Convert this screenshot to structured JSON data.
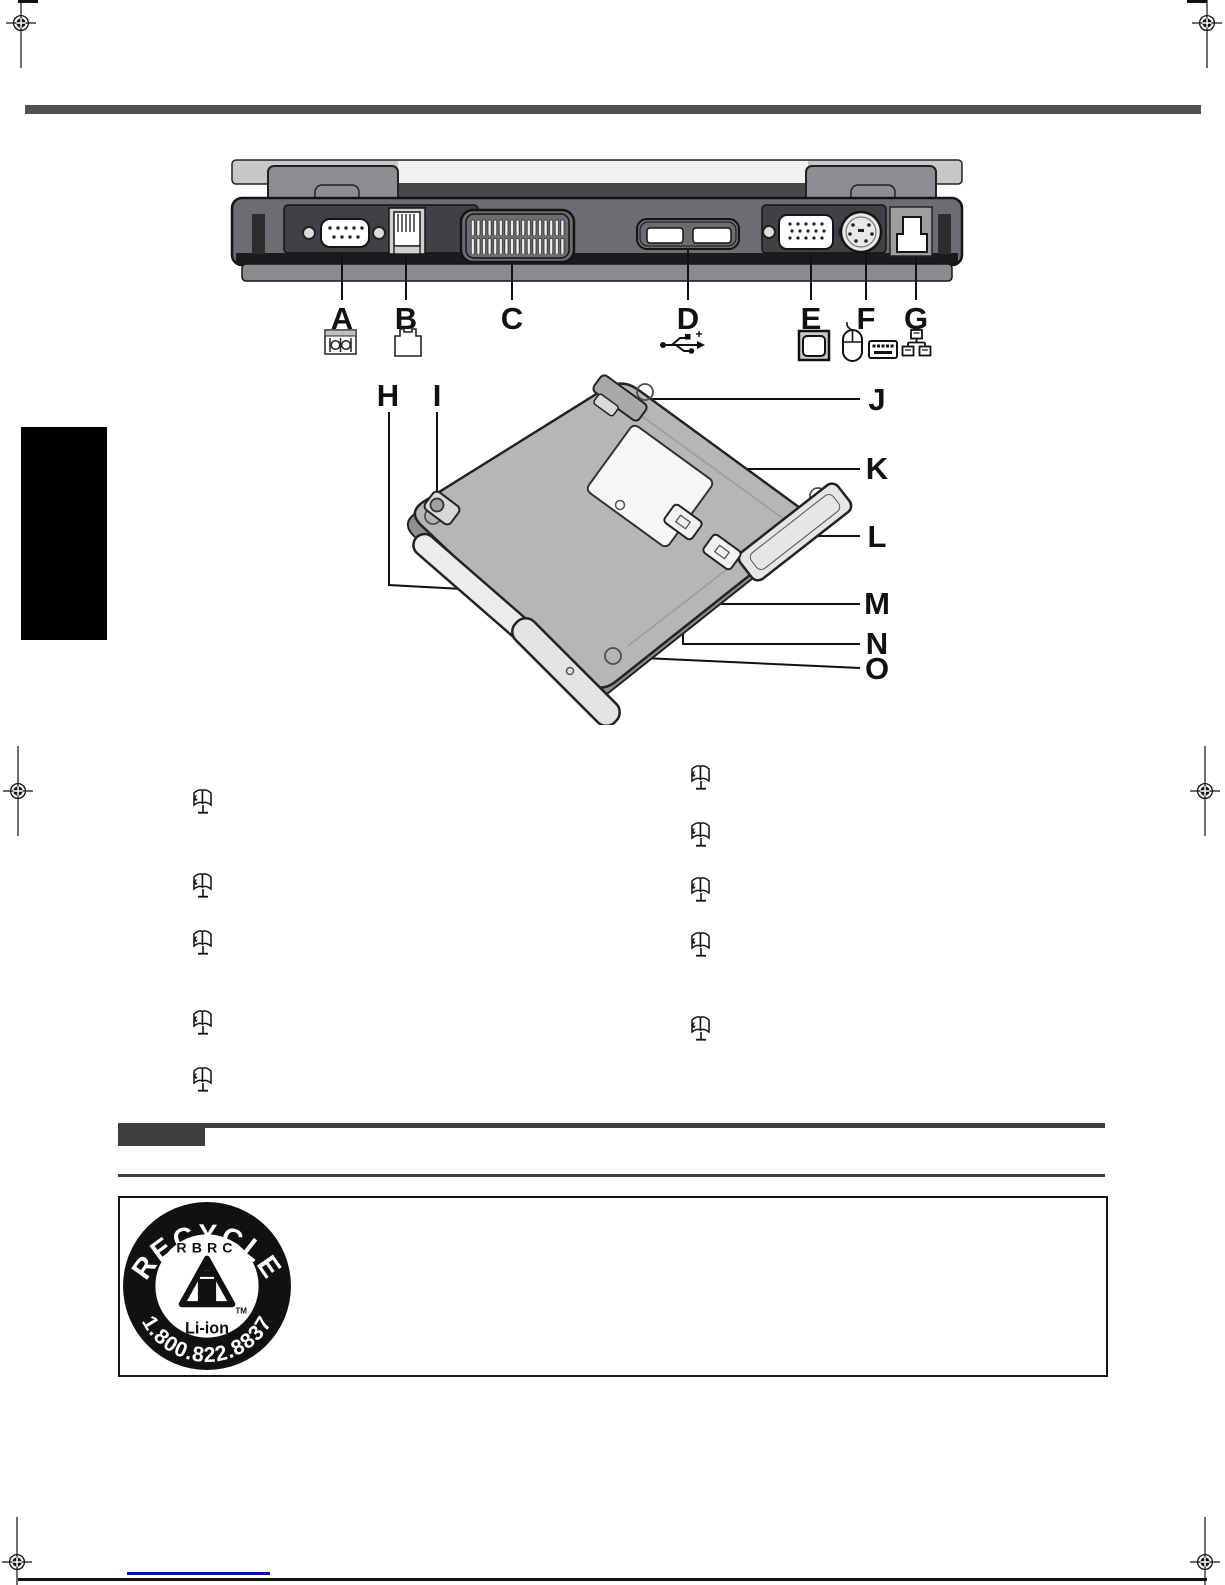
{
  "page_title": "Laptop parts identification manual page",
  "rear_view": {
    "port_labels": [
      "A",
      "B",
      "C",
      "D",
      "E",
      "F",
      "G"
    ],
    "port_icons": [
      "serial-port",
      "modem-jack",
      "ventilation",
      "usb",
      "external-display",
      "mouse-keyboard",
      "lan"
    ]
  },
  "bottom_view": {
    "part_labels": [
      "H",
      "I",
      "J",
      "K",
      "L",
      "M",
      "N",
      "O"
    ]
  },
  "reference_icons": {
    "name": "reference-manual-book-icon",
    "count": 10
  },
  "recycle_seal": {
    "top_text": "RECYCLE",
    "org": "RBRC",
    "chemistry": "Li-ion",
    "phone": "1.800.822.8837",
    "trademark": "TM"
  },
  "colors": {
    "rule": "#3d3e40",
    "top_bar": "#4f5052",
    "link": "#0a0acc",
    "laptop_body": "#6c6d70",
    "laptop_bottom": "#b5b6b8"
  }
}
